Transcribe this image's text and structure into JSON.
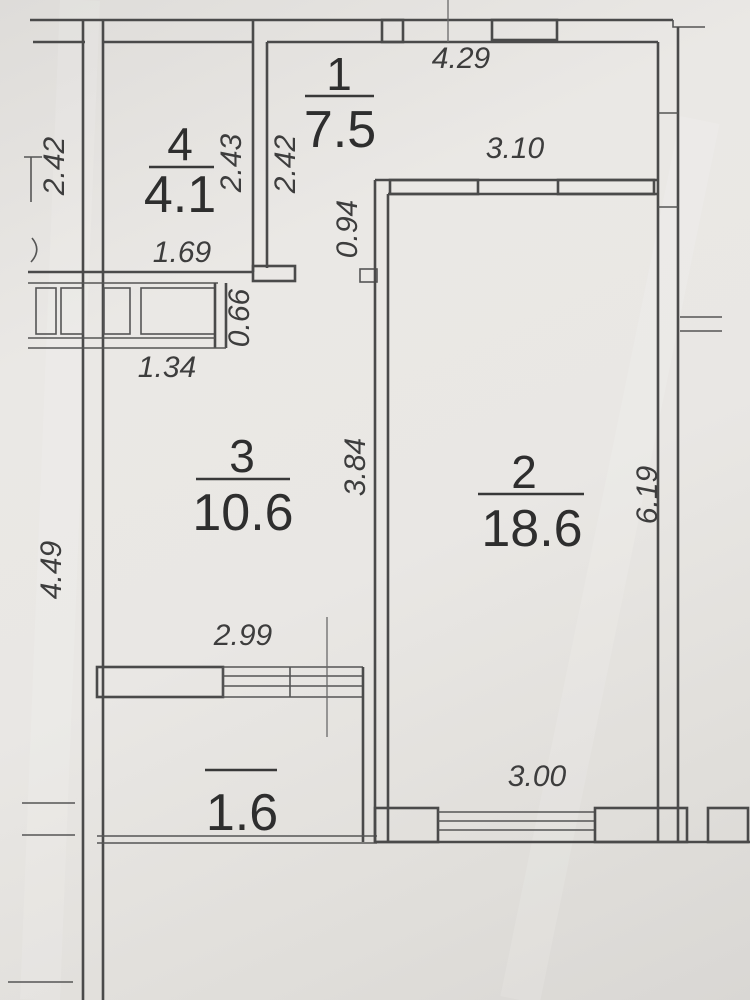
{
  "page": {
    "title": "Apartment floor plan"
  },
  "rooms": {
    "room1": {
      "number": "1",
      "area": "7.5"
    },
    "room2": {
      "number": "2",
      "area": "18.6"
    },
    "room3": {
      "number": "3",
      "area": "10.6"
    },
    "room4": {
      "number": "4",
      "area": "4.1"
    },
    "balcony": {
      "area": "1.6"
    }
  },
  "dimensions": {
    "outer_left_upper": "2.42",
    "room4_right": "2.43",
    "room1_left": "2.42",
    "top_width": "4.29",
    "room2_top_width": "3.10",
    "hall_upper_right": "0.94",
    "room4_bottom": "1.69",
    "closet_height": "0.66",
    "closet_width": "1.34",
    "room3_right": "3.84",
    "room2_right": "6.19",
    "room3_left": "4.49",
    "room3_bottom": "2.99",
    "room2_bottom": "3.00"
  }
}
